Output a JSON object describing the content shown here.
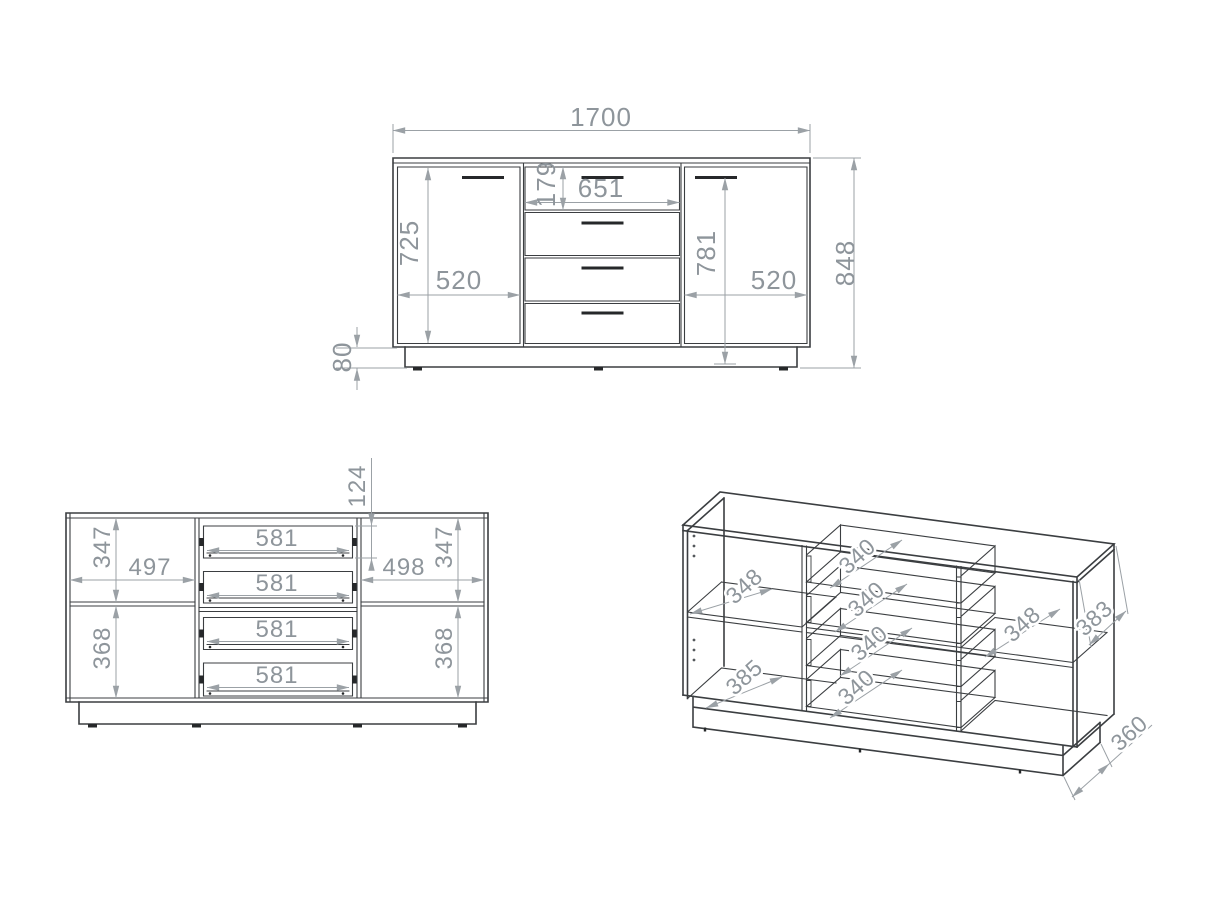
{
  "drawing": {
    "front_view": {
      "total_width": "1700",
      "total_height": "848",
      "left_door_height": "725",
      "left_door_width": "520",
      "top_drawer_height": "179",
      "drawer_section_width": "651",
      "right_door_height": "781",
      "right_door_width": "520",
      "plinth_height": "80"
    },
    "internal_view": {
      "left_top_compartment_height": "347",
      "left_compartment_width": "497",
      "left_bottom_compartment_height": "368",
      "drawer_box_height": "124",
      "drawer_widths": [
        "581",
        "581",
        "581",
        "581"
      ],
      "right_compartment_width": "498",
      "right_top_compartment_height": "347",
      "right_bottom_compartment_height": "368"
    },
    "perspective_view": {
      "left_shelf_depth": "348",
      "left_bottom_depth": "385",
      "drawer_depths": [
        "340",
        "340",
        "340",
        "340"
      ],
      "right_shelf_depth": "348",
      "side_panel_depth": "383",
      "plinth_depth": "360"
    },
    "colors": {
      "outline": "#3b3e41",
      "dimension": "#9ba1a6",
      "dimension_text": "#8e959b",
      "handle": "#26282a",
      "background": "#ffffff"
    }
  }
}
